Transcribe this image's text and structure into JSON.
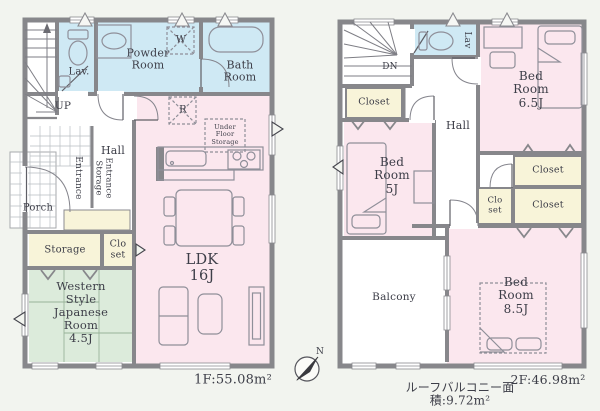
{
  "floor1": {
    "area_label": "1F:55.08m²",
    "stairs_label": "UP",
    "rooms": {
      "lav": "Lav.",
      "powder_room": "Powder\nRoom",
      "bath_room": "Bath\nRoom",
      "hall": "Hall",
      "porch": "Porch",
      "entrance": "Entrance",
      "entrance_storage": "Entrance\nStorage",
      "storage": "Storage",
      "closet": "Clo\nset",
      "western_room": "Western\nStyle\nJapanese\nRoom\n4.5J",
      "ldk": "LDK\n16J",
      "under_floor_storage": "Under\nFloor\nStorage",
      "washer_symbol": "W",
      "fridge_symbol": "R"
    }
  },
  "floor2": {
    "area_label": "2F:46.98m²",
    "roof_balcony_label": "ルーフバルコニー面積:9.72m²",
    "stairs_label": "DN",
    "rooms": {
      "lav": "Lav",
      "hall": "Hall",
      "closet_stairs": "Closet",
      "bedroom_65": "Bed\nRoom\n6.5J",
      "bedroom_5": "Bed\nRoom\n5J",
      "bedroom_85": "Bed\nRoom\n8.5J",
      "closet_upper": "Closet",
      "closet_small": "Clo\nset",
      "closet_lower": "Closet",
      "balcony": "Balcony"
    }
  },
  "compass": {
    "north": "N"
  },
  "colors": {
    "background": "#f2f4ef",
    "wall": "#87878b",
    "room_pink": "#fbe7ee",
    "room_blue": "#cfe9f4",
    "room_cream": "#f8f4d9",
    "room_green": "#dcebdb",
    "text": "#3d3e48"
  }
}
